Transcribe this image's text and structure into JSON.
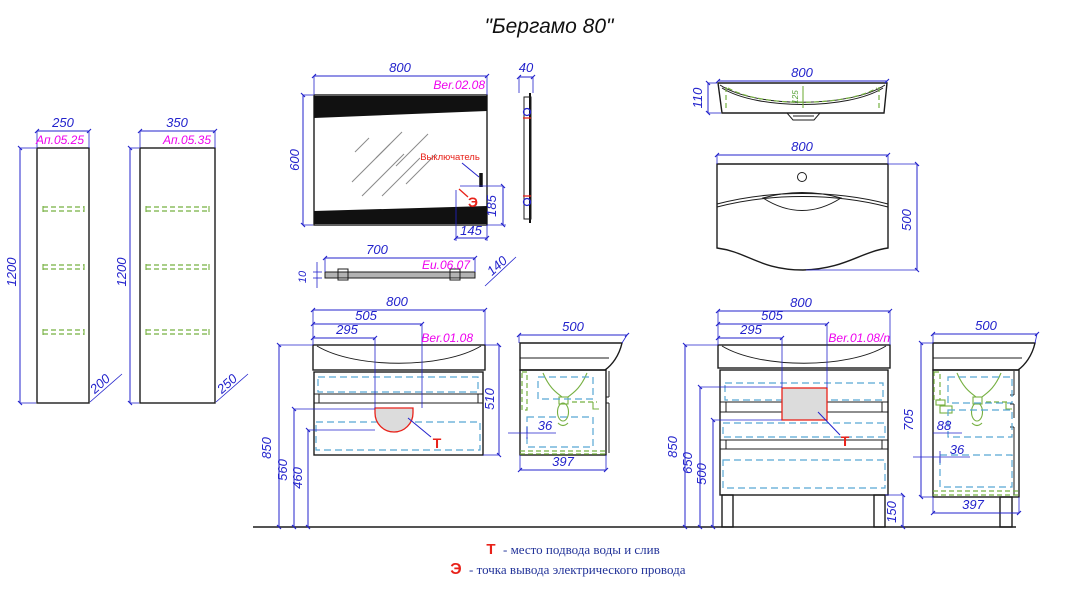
{
  "title": "\"Бергамо 80\"",
  "cabinet_250": {
    "width": "250",
    "code": "Ап.05.25",
    "height": "1200",
    "depth": "200"
  },
  "cabinet_350": {
    "width": "350",
    "code": "Ап.05.35",
    "height": "1200",
    "depth": "250"
  },
  "mirror": {
    "width": "800",
    "height": "600",
    "code": "Ber.02.08",
    "side_width": "40",
    "switch_label": "Выключатель",
    "electric_mark": "Э",
    "dim_185": "185",
    "dim_145": "145"
  },
  "shelf": {
    "width": "700",
    "code": "Eu.06.07",
    "thickness": "10",
    "depth": "140"
  },
  "sink_profile": {
    "width": "800",
    "height": "110",
    "basin_depth": "125"
  },
  "sink_top": {
    "width": "800",
    "depth": "500"
  },
  "vanity": {
    "width": "800",
    "dim_505": "505",
    "dim_295": "295",
    "code": "Ber.01.08",
    "height": "510",
    "floor_850": "850",
    "floor_560": "560",
    "floor_460": "460",
    "water_mark": "Т"
  },
  "vanity_side": {
    "width": "500",
    "dim_36": "36",
    "bottom_width": "397"
  },
  "vanity_n": {
    "width": "800",
    "dim_505": "505",
    "dim_295": "295",
    "code": "Ber.01.08/n",
    "floor_850": "850",
    "floor_650": "650",
    "floor_500": "500",
    "legs_height": "150",
    "height_705": "705",
    "water_mark": "Т"
  },
  "vanity_n_side": {
    "width": "500",
    "dim_88": "88",
    "dim_36": "36",
    "bottom_width": "397"
  },
  "legend": {
    "t_symbol": "Т",
    "t_text": "- место подвода воды и слив",
    "e_symbol": "Э",
    "e_text": "- точка вывода электрического провода"
  },
  "colors": {
    "dimension": "#2323cc",
    "code": "#ee00ee",
    "annotation": "#e8221a",
    "hardware": "#76b041",
    "drawer": "#58a6d4"
  }
}
